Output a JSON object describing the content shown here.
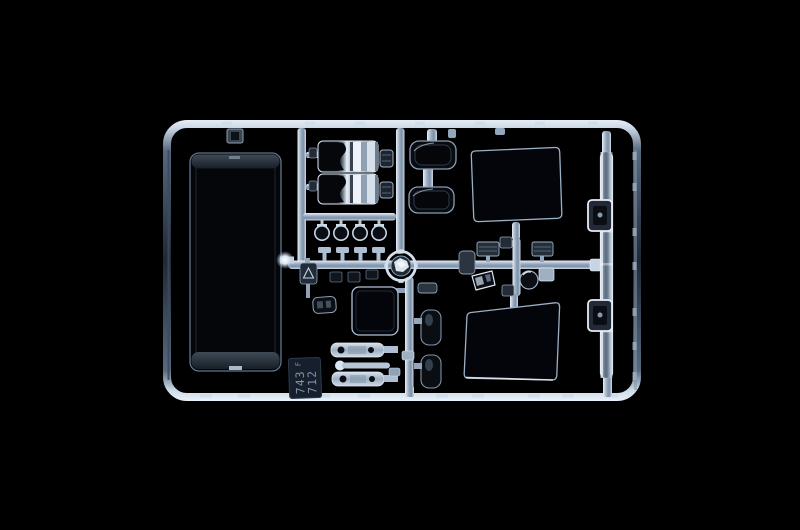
{
  "scene": {
    "type": "product-photo",
    "subject": "Clear transparent plastic model-kit sprue (parts tree) photographed on a black background",
    "background_color": "#000000"
  },
  "sprue": {
    "material_colors": {
      "highlight": "#e8f0f8",
      "runner_light": "#aebfd3",
      "runner_mid": "#8fa2b8",
      "frame_shadow": "#222c39",
      "clear_part_fill": "#04060a",
      "dark_part_fill": "#0a0d12",
      "chrome_bright": "#eef3f9"
    },
    "id_tag": {
      "plate_color": "#161f2b",
      "text_color": "#7e93ad",
      "letter": "F",
      "mold_number_left": "743",
      "mold_number_right": "712"
    },
    "parts": [
      "windshield-pane",
      "headlamp-cluster-top",
      "headlamp-cluster-bottom",
      "round-lens-row",
      "clip-row",
      "warning-triangle-plate",
      "small-dark-lens",
      "small-clear-window",
      "round-spotlight-lens",
      "light-bar-top",
      "wiper-rod",
      "light-bar-bottom",
      "dark-lens-pair",
      "side-window-top",
      "side-window-bottom",
      "seat-cushion-top",
      "seat-cushion-bottom",
      "indicator-lens-left",
      "indicator-lens-right",
      "mirror-glass-small",
      "round-lamp-small",
      "sun-visor-strip",
      "mirror-housing-top",
      "mirror-housing-bottom"
    ]
  }
}
